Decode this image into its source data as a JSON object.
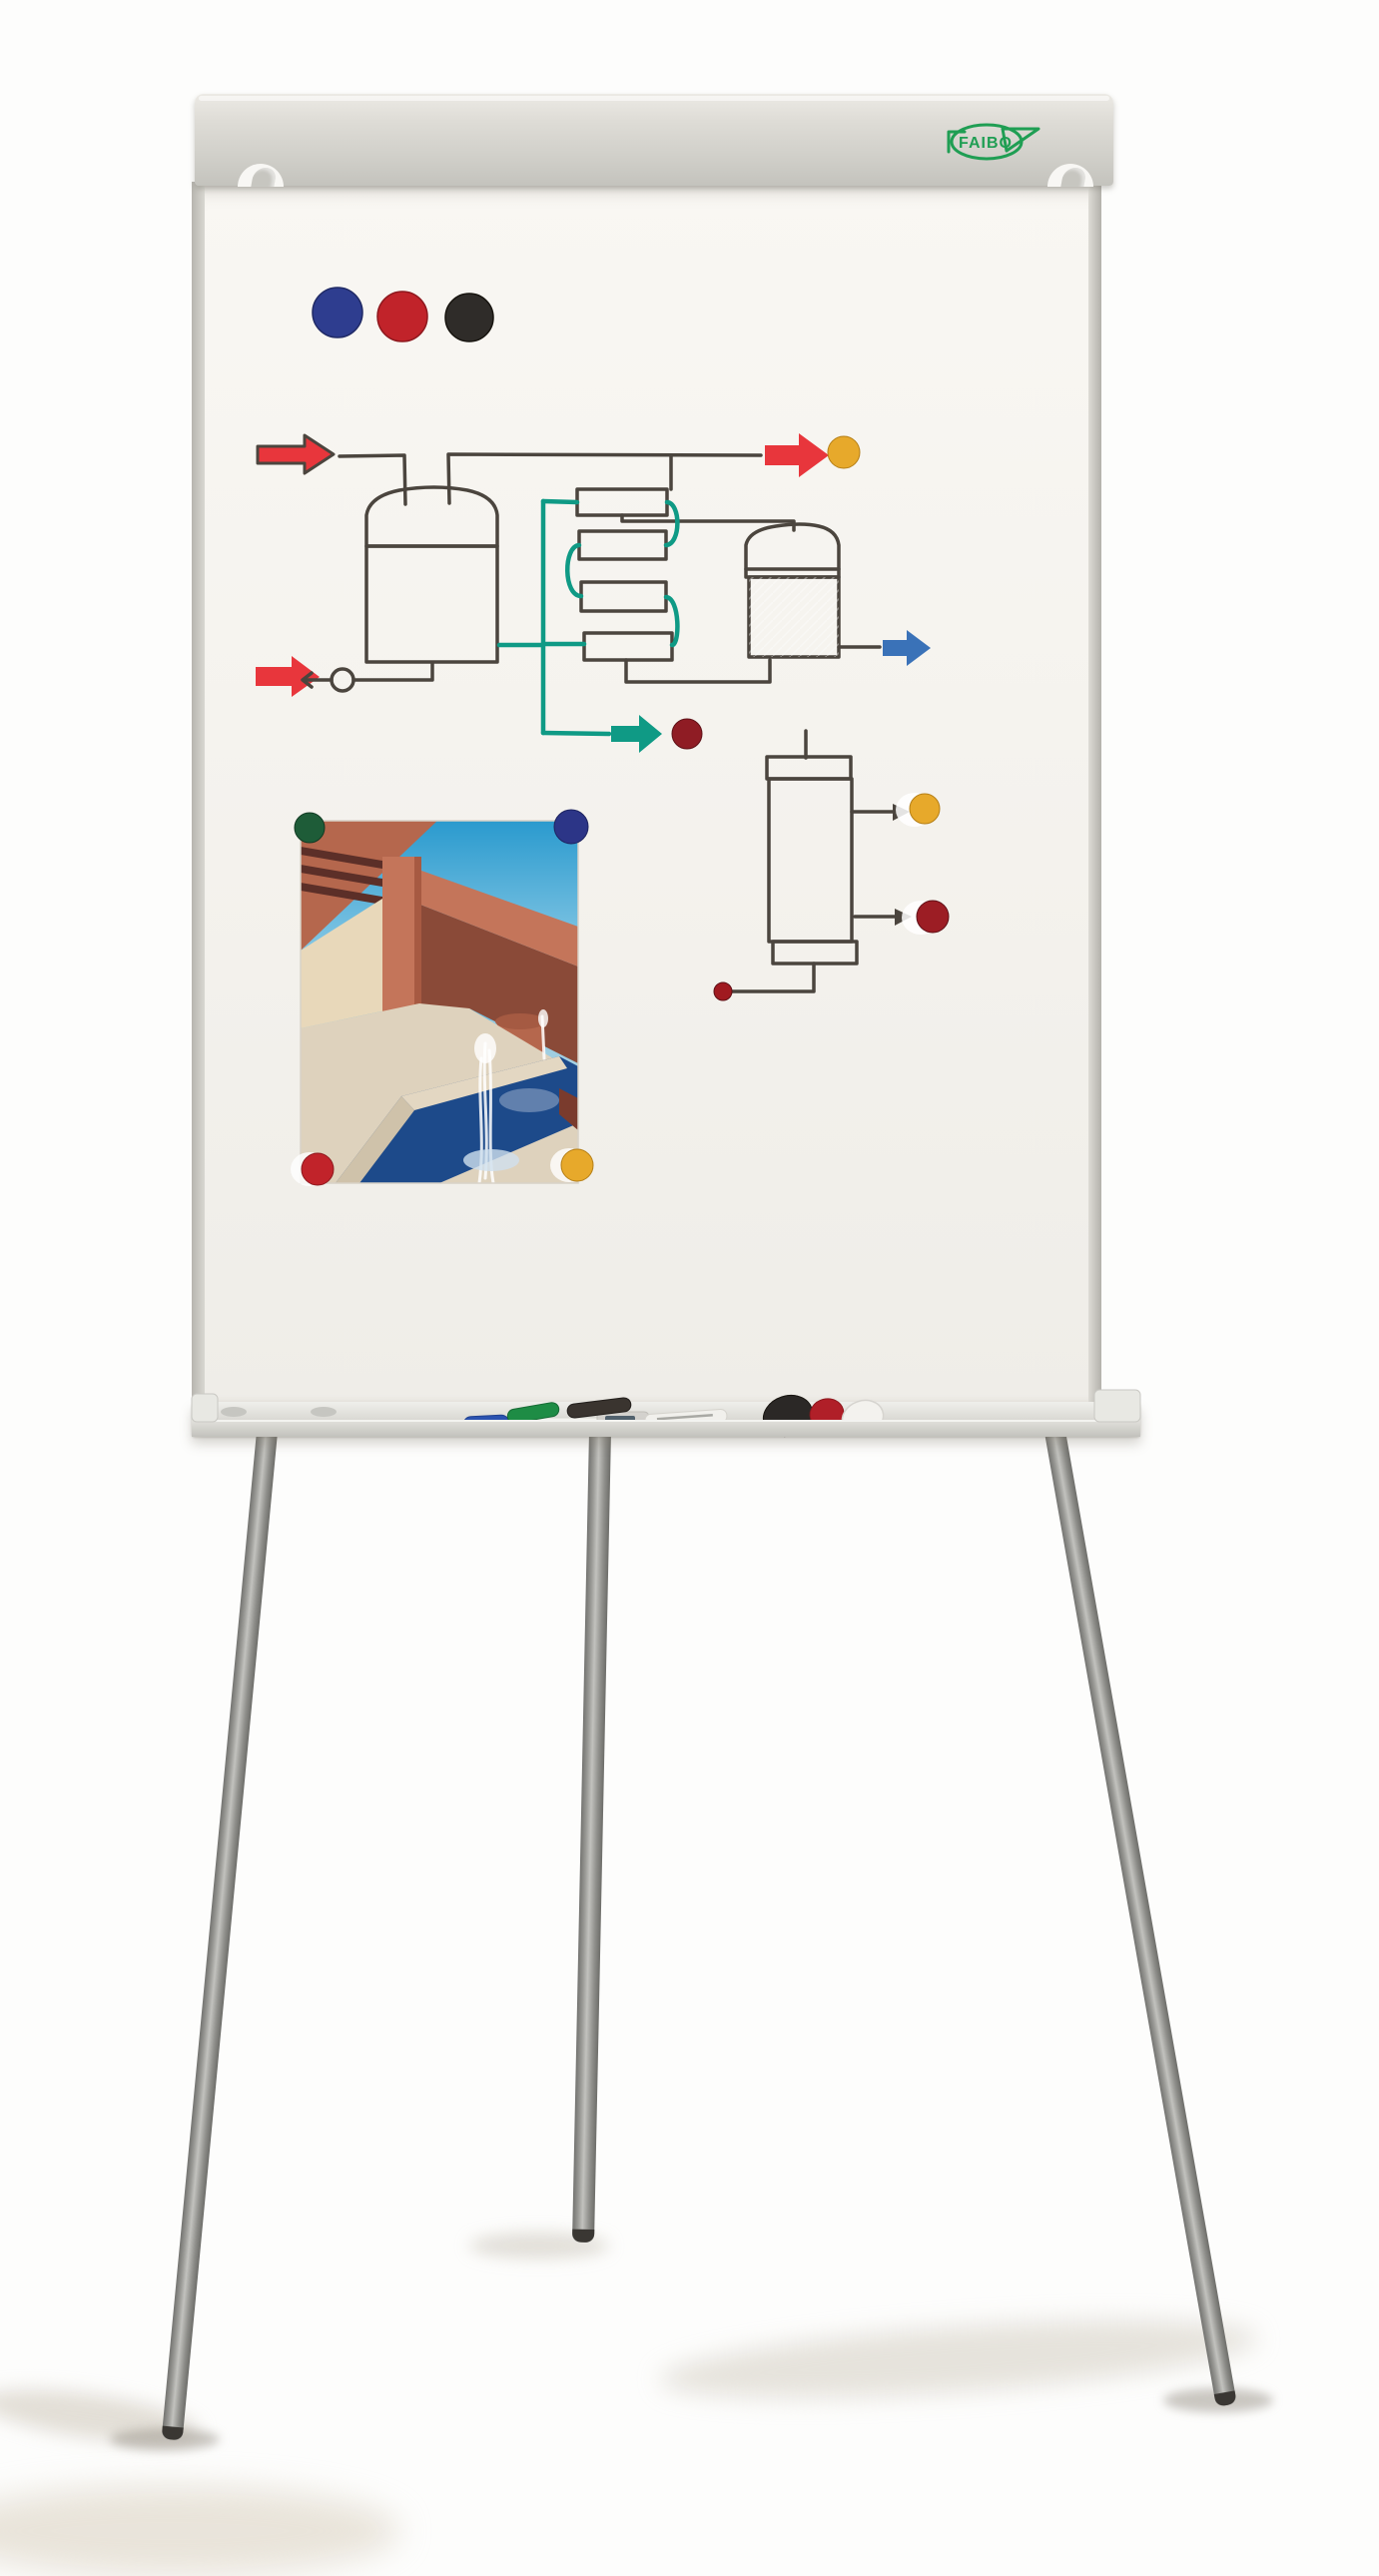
{
  "scene": {
    "title": "Magnetic whiteboard flipchart easel on tripod stand",
    "background": "#fdfdfc"
  },
  "brand": {
    "logo_text": "FAIBO",
    "logo_color": "#1f9e53"
  },
  "board": {
    "surface_color": "#f5f3ee",
    "frame_color": "#c9c7c1",
    "rail_color": "#d5d4ce",
    "tray_color": "#d9d9d4"
  },
  "legs": {
    "count": 3,
    "color": "#9b9b97",
    "tip_color": "#3a3733"
  },
  "magnets": {
    "top_row": [
      {
        "label": "blue magnet",
        "color": "#2e3d8f"
      },
      {
        "label": "red magnet",
        "color": "#c1232a"
      },
      {
        "label": "black magnet",
        "color": "#2f2c29"
      }
    ],
    "diagram": [
      {
        "label": "yellow magnet",
        "color": "#e7a92b"
      },
      {
        "label": "dark red magnet",
        "color": "#8f1c24"
      }
    ],
    "column": [
      {
        "label": "yellow magnet",
        "color": "#e7a92b"
      },
      {
        "label": "dark red magnet",
        "color": "#9c1d24"
      },
      {
        "label": "small red magnet",
        "color": "#a01a20"
      }
    ],
    "photo_corners": [
      {
        "label": "green magnet",
        "color": "#1e5c38"
      },
      {
        "label": "navy magnet",
        "color": "#2c3587"
      },
      {
        "label": "red magnet",
        "color": "#c1232a"
      },
      {
        "label": "yellow magnet",
        "color": "#e7a92b"
      }
    ],
    "tray": [
      {
        "label": "black magnet",
        "color": "#2b2826"
      },
      {
        "label": "red magnet",
        "color": "#b01f28"
      },
      {
        "label": "white magnet",
        "color": "#f3f2ee"
      }
    ]
  },
  "diagram": {
    "description": "Hand-drawn marker process flow: red feed arrows into a green-filled tank with pump, serpentine of four green exchanger blocks with teal recycle loop, blue-filled tank with blue outlet arrow, teal product arrow, and a hatched column with red top and bottom bands",
    "ink_color": "#4b453e",
    "red_arrow_color": "#e8363c",
    "teal_color": "#0f9a85",
    "tank1_fill": "#abd6b0",
    "block_fill": "#b9dcbc",
    "tank2_fill": "#3a72b8",
    "blue_arrow_color": "#3a72b8",
    "pump_fill": "#f6f4f0",
    "column_band_color": "#e62520",
    "column_hatch_color": "#7fa3c9"
  },
  "photo": {
    "description": "Pinned photo of a modern terracotta house with pergola, awning, pool and fountain jet",
    "sky_top": "#2a9ace",
    "sky_bottom": "#b5dff0",
    "roof": "#b5674d",
    "wall": "#c4755a",
    "wall_dark": "#8a4a38",
    "awning": "#e8d8ba",
    "terrace": "#ded2bd",
    "pool": "#1d4a8a",
    "lawn": "#7fa863",
    "spray": "#ffffff"
  },
  "tray_items": {
    "markers": [
      {
        "label": "blue marker",
        "color": "#2a52b0"
      },
      {
        "label": "green marker",
        "color": "#1e8c45"
      },
      {
        "label": "black marker",
        "color": "#3a342f"
      },
      {
        "label": "white marker",
        "color": "#f1f0ec"
      }
    ]
  }
}
